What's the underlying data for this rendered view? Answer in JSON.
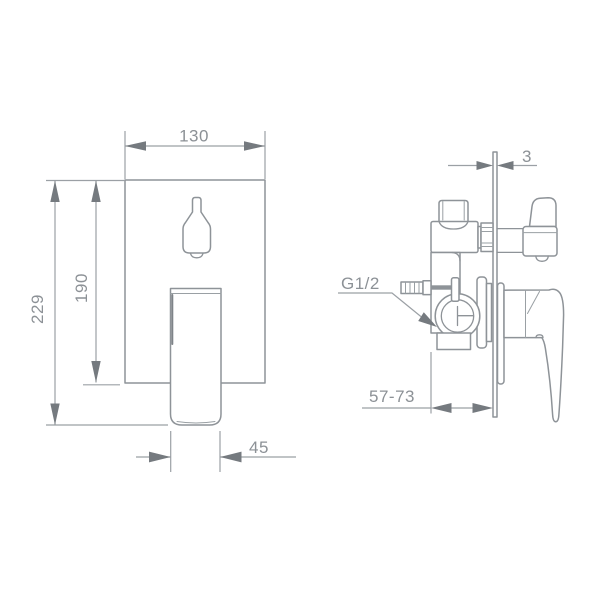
{
  "drawing": {
    "kind": "technical dimension drawing",
    "subject": "concealed shower mixer valve with diverter and lever handle, front and side views",
    "background_color": "#ffffff",
    "line_color": "#8e9398",
    "dimension_color": "#9ba0a5",
    "text_color": "#8c9196"
  },
  "dims": {
    "plate_width": "130",
    "plate_height": "190",
    "total_height": "229",
    "handle_width": "45",
    "plate_thickness": "3",
    "install_depth_range": "57-73",
    "inlet_thread": "G1/2"
  }
}
